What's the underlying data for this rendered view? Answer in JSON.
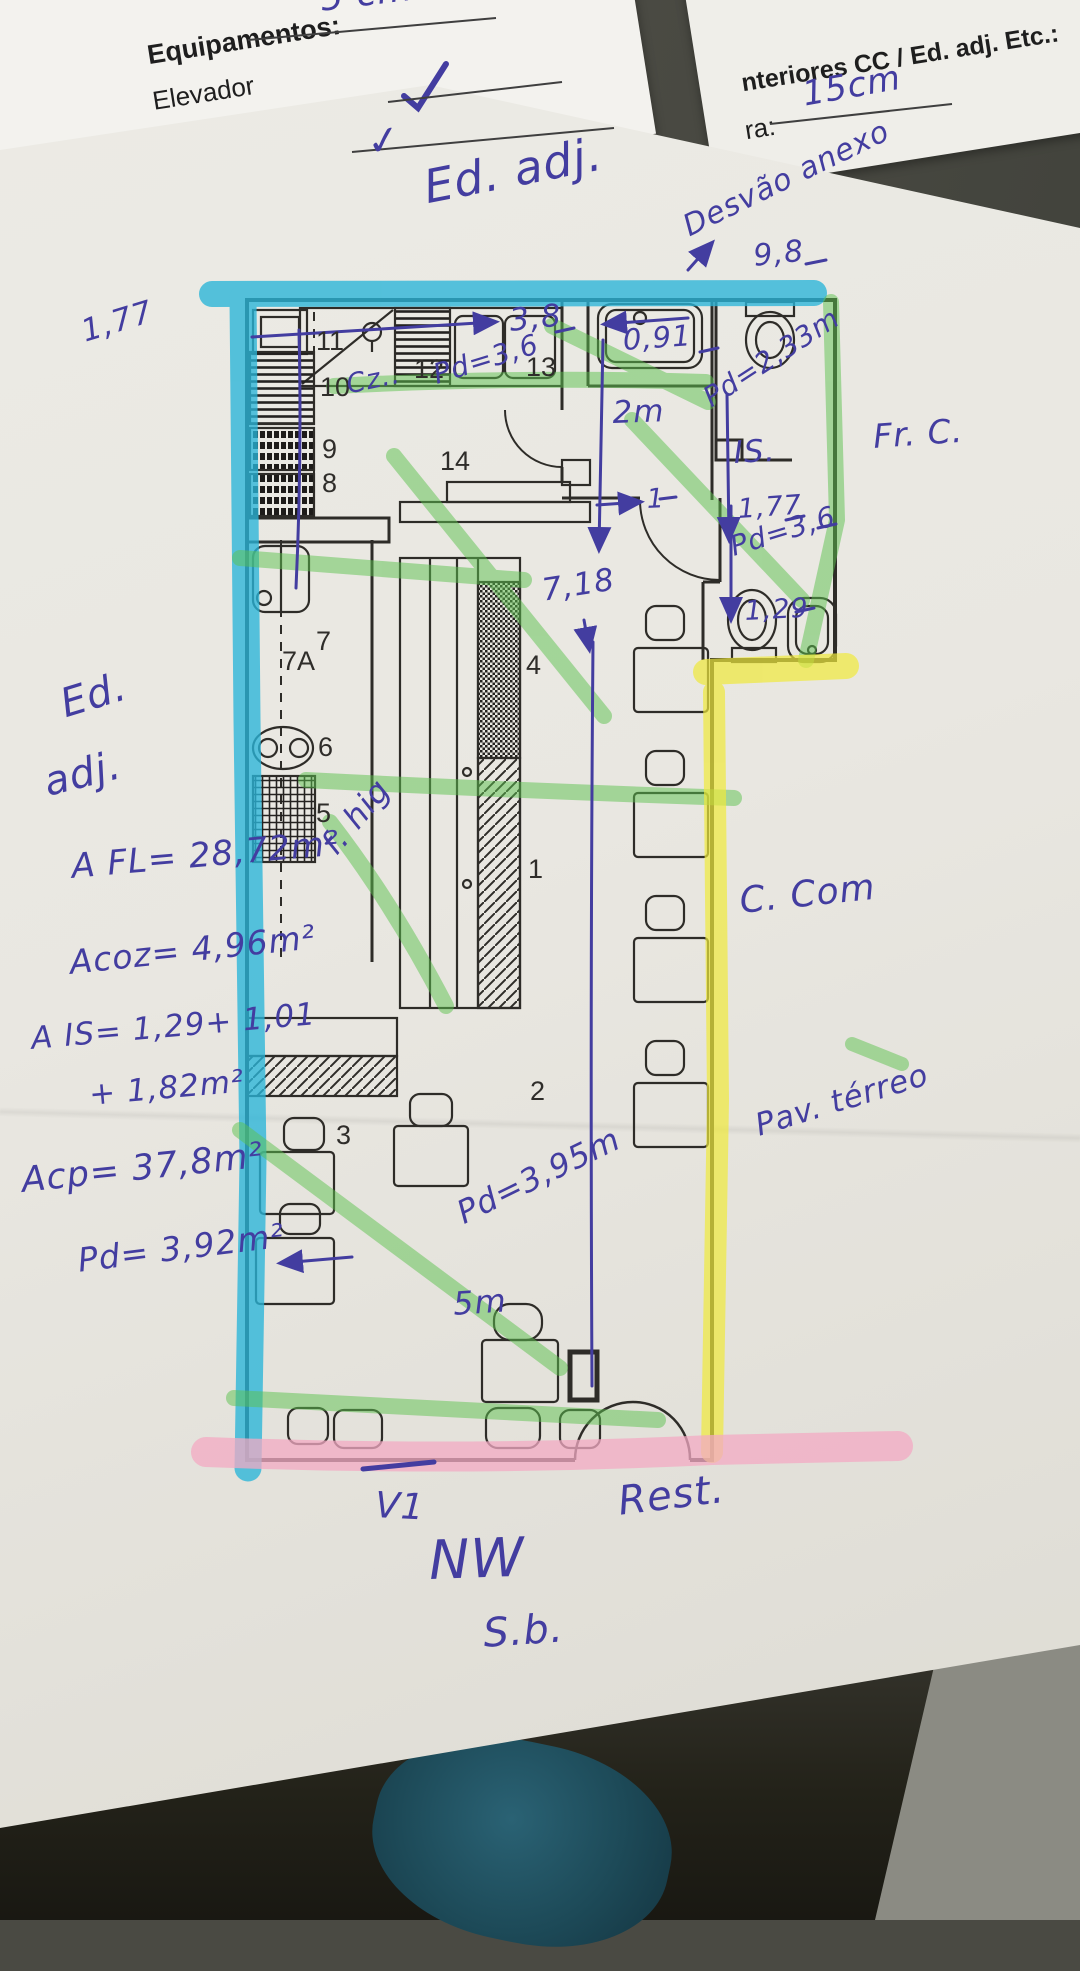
{
  "photo": {
    "background": "#4a4a43",
    "paper": "#e9e7e1",
    "ink_color": "#433da0",
    "highlighters": {
      "cyan": "#29b5d8",
      "green": "#5cc24e",
      "yellow": "#efe93c",
      "pink": "#f3a9c3"
    }
  },
  "sheet_top_left": {
    "fragment": "5 cm",
    "heading": "Equipamentos:",
    "item_1": "Elevador",
    "item_1_mark": "✓",
    "item_2": "Rede de Gá"
  },
  "sheet_top_right": {
    "heading": "nteriores CC / Ed. adj. Etc.:",
    "field_label": "ra:",
    "field_value": "15cm"
  },
  "plan": {
    "room_numbers": [
      "11",
      "12",
      "13",
      "10",
      "9",
      "8",
      "14",
      "7",
      "7A",
      "6",
      "5",
      "4",
      "1",
      "2",
      "3"
    ]
  },
  "annotations": {
    "ed_adj_top": "Ed. adj.",
    "desvao_anexo": "Desvão anexo",
    "dim_9_8": "9,8",
    "dim_0_91": "0,91",
    "pd_2_33": "Pd=2,33m",
    "is_room": "IS.",
    "dim_1_77_right": "1,77",
    "dim_2m": "2m",
    "dim_3_8": "3,8",
    "dim_1_77_left": "1,77",
    "cz": "Cz..",
    "pd_3_6_kitchen": "Pd=3,6",
    "dim_1_wc": "1",
    "pd_3_6_wc": "Pd=3,6",
    "dim_1_29": "1,29",
    "dim_7_18": "7,18",
    "f_hig": "f. hig",
    "ed_left_1": "Ed.",
    "ed_left_2": "adj.",
    "area_fl": "A FL= 28,72m²",
    "area_coz": "Acoz= 4,96m²",
    "area_is_1": "A IS= 1,29+ 1,01",
    "area_is_2": "+ 1,82m²",
    "area_cp": "Acp= 37,8m²",
    "pd_3_92": "Pd= 3,92m²",
    "fr_c": "Fr. C.",
    "c_com": "C. Com",
    "pav_terreo": "Pav. térreo",
    "pd_3_95": "Pd=3,95m",
    "dim_5m": "5m",
    "v1": "V1",
    "rest": "Rest.",
    "nw": "NW",
    "sb": "S.b."
  }
}
